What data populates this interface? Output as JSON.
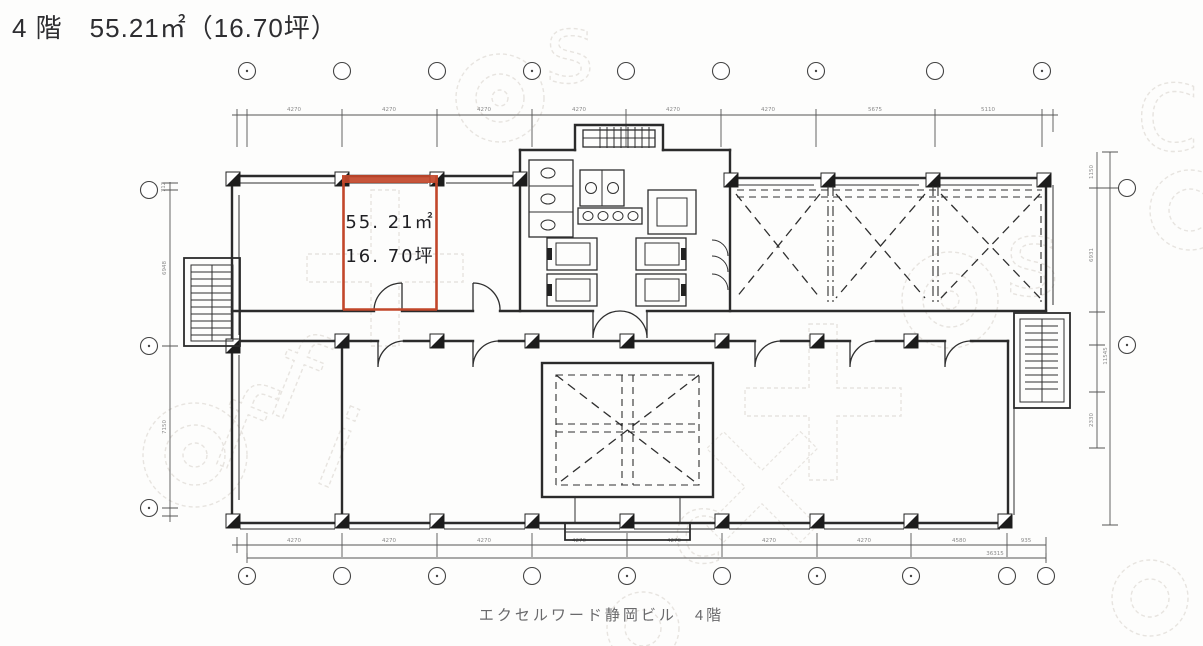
{
  "header": {
    "title": "4 階　55.21㎡（16.70坪）"
  },
  "room": {
    "area_m2": "55. 21㎡",
    "area_tsubo": "16. 70坪",
    "border_color": "#c2472a"
  },
  "footer": {
    "caption": "エクセルワード静岡ビル　4階"
  },
  "watermark": {
    "letters": {
      "f": "f",
      "i": "i",
      "c": "c",
      "s": "s"
    },
    "color": "#d6d0c8"
  },
  "dims": {
    "top": [
      "4270",
      "4270",
      "4270",
      "4270",
      "4270",
      "4270",
      "5675",
      "5110"
    ],
    "bottom": [
      "4270",
      "4270",
      "4270",
      "4270",
      "4270",
      "4270",
      "4270",
      "4580",
      "935"
    ],
    "bottom_total": "36315",
    "left": [
      "712",
      "6948",
      "7150"
    ],
    "right": [
      "1150",
      "6931",
      "2330",
      "11545"
    ]
  }
}
